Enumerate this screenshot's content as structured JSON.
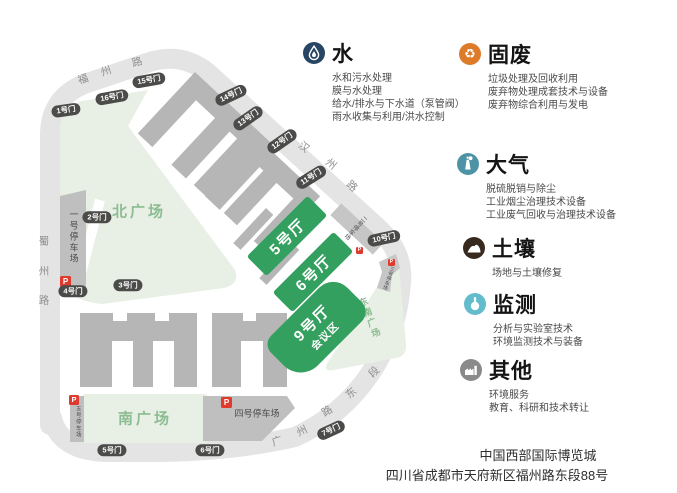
{
  "map": {
    "roads": {
      "fuzhou": [
        "福",
        "州",
        "路"
      ],
      "hanzhou": [
        "汉",
        "州",
        "路"
      ],
      "shuzhou": [
        "蜀",
        "州",
        "路"
      ],
      "guangzhou": [
        "广",
        "州",
        "路",
        "东",
        "段"
      ]
    },
    "gates": [
      "1号门",
      "2号门",
      "3号门",
      "4号门",
      "5号门",
      "6号门",
      "7号门",
      "10号门",
      "11号门",
      "12号门",
      "13号门",
      "14号门",
      "15号门",
      "16号门"
    ],
    "plazas": {
      "north": "北广场",
      "south": "南广场",
      "southeast": "东南广场"
    },
    "parkings": {
      "p1": "一号停车场",
      "p2": "二号停车场",
      "p3": "三号停车场",
      "p4": "四号停车场",
      "p5": "五号停车场",
      "p_symbol": "P"
    },
    "halls": {
      "hall5": "5号厅",
      "hall6": "6号厅",
      "hall9": "9号厅",
      "hall9_sub": "会议区"
    }
  },
  "legend": [
    {
      "id": "water",
      "title": "水",
      "color": "#274663",
      "icon": "water-drop-icon",
      "lines": [
        "水和污水处理",
        "膜与水处理",
        "给水/排水与下水道（泵管阀）",
        "雨水收集与利用/洪水控制"
      ]
    },
    {
      "id": "solid-waste",
      "title": "固废",
      "color": "#dd7b28",
      "icon": "recycle-icon",
      "recycle_glyph": "♻",
      "lines": [
        "垃圾处理及回收利用",
        "废弃物处理成套技术与设备",
        "废弃物综合利用与发电"
      ]
    },
    {
      "id": "air",
      "title": "大气",
      "color": "#4e93a5",
      "icon": "chimney-icon",
      "lines": [
        "脱硫脱销与除尘",
        "工业烟尘治理技术设备",
        "工业废气回收与治理技术设备"
      ]
    },
    {
      "id": "soil",
      "title": "土壤",
      "color": "#38291f",
      "icon": "soil-mound-icon",
      "lines": [
        "场地与土壤修复"
      ]
    },
    {
      "id": "monitoring",
      "title": "监测",
      "color": "#63bccd",
      "icon": "flask-icon",
      "lines": [
        "分析与实验室技术",
        "环境监测技术与装备"
      ]
    },
    {
      "id": "other",
      "title": "其他",
      "color": "#8a8a8a",
      "icon": "factory-icon",
      "lines": [
        "环境服务",
        "教育、科研和技术转让"
      ]
    }
  ],
  "footer": {
    "line1": "中国西部国际博览城",
    "line2": "四川省成都市天府新区福州路东段88号"
  },
  "colors": {
    "hall_green": "#33a05f",
    "plaza_green": "#e8efe4",
    "plaza_text": "#8cbc92",
    "road_gray": "#e4e4e4",
    "building_gray": "#b6b6b6",
    "badge_dark": "#4b4b49",
    "parking_red": "#e03a2f"
  }
}
